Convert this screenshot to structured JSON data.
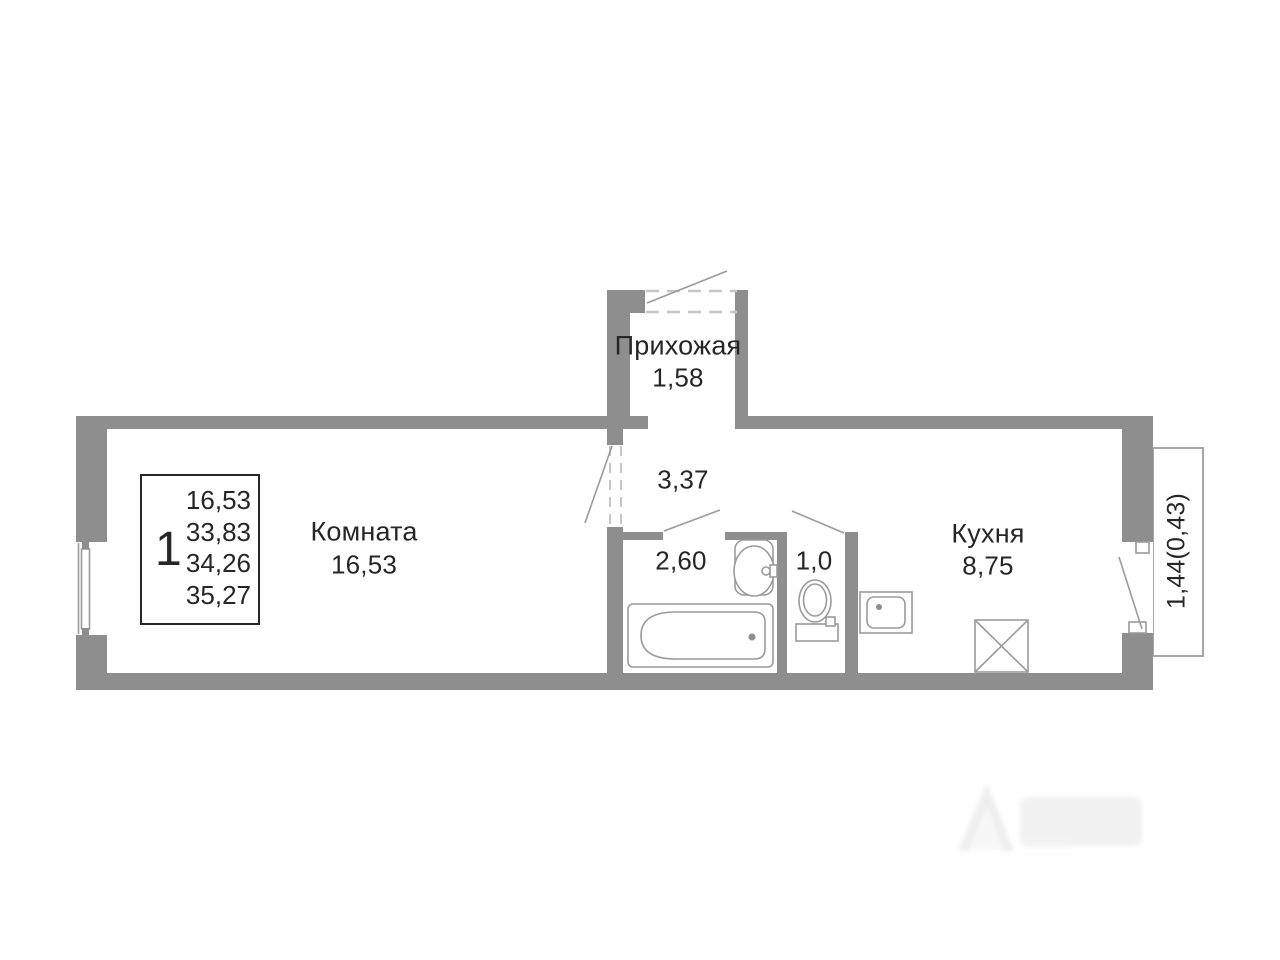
{
  "colors": {
    "wall": "#8e8e8e",
    "fixture": "#9b9b9b",
    "dash": "#c6c6c6",
    "text": "#262626",
    "balcony_border": "#a6a6a6"
  },
  "summary": {
    "room_count": "1",
    "values": [
      "16,53",
      "33,83",
      "34,26",
      "35,27"
    ]
  },
  "rooms": {
    "living": {
      "label": "Комната",
      "area": "16,53"
    },
    "hallway": {
      "label": "Прихожая",
      "area": "1,58"
    },
    "corridor": {
      "area": "3,37"
    },
    "bathroom": {
      "area": "2,60"
    },
    "wc": {
      "area": "1,0"
    },
    "kitchen": {
      "label": "Кухня",
      "area": "8,75"
    },
    "balcony": {
      "area": "1,44(0,43)"
    }
  }
}
